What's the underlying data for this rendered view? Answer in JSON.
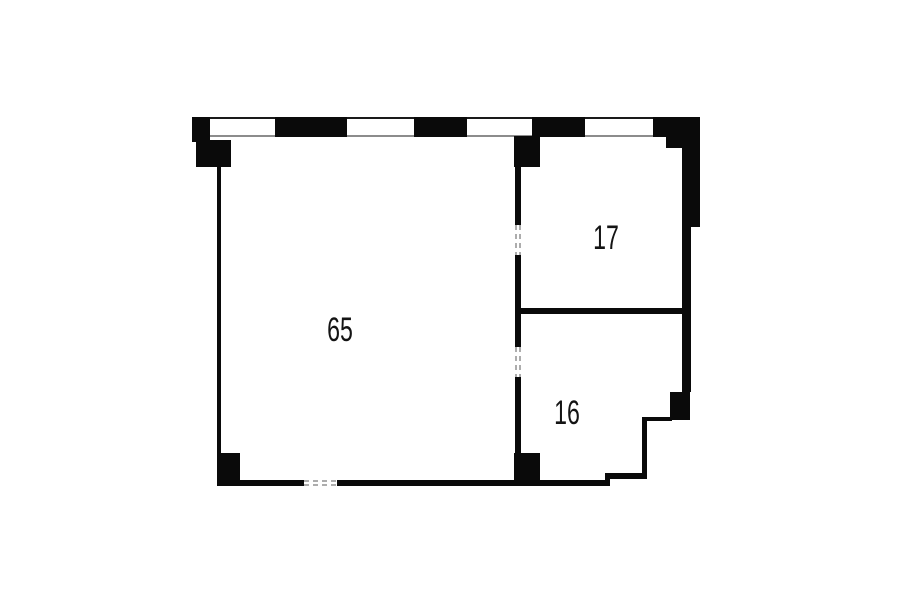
{
  "floor_plan": {
    "type": "apartment-floor-plan",
    "background_color": "#ffffff",
    "wall_color": "#0a0a0a",
    "window_line_color": "#8c8c8c",
    "door_dash_color": "#adadad",
    "label_color": "#141414",
    "rooms": [
      {
        "name": "room-65",
        "area_label": "65"
      },
      {
        "name": "room-17",
        "area_label": "17"
      },
      {
        "name": "room-16",
        "area_label": "16"
      }
    ]
  }
}
